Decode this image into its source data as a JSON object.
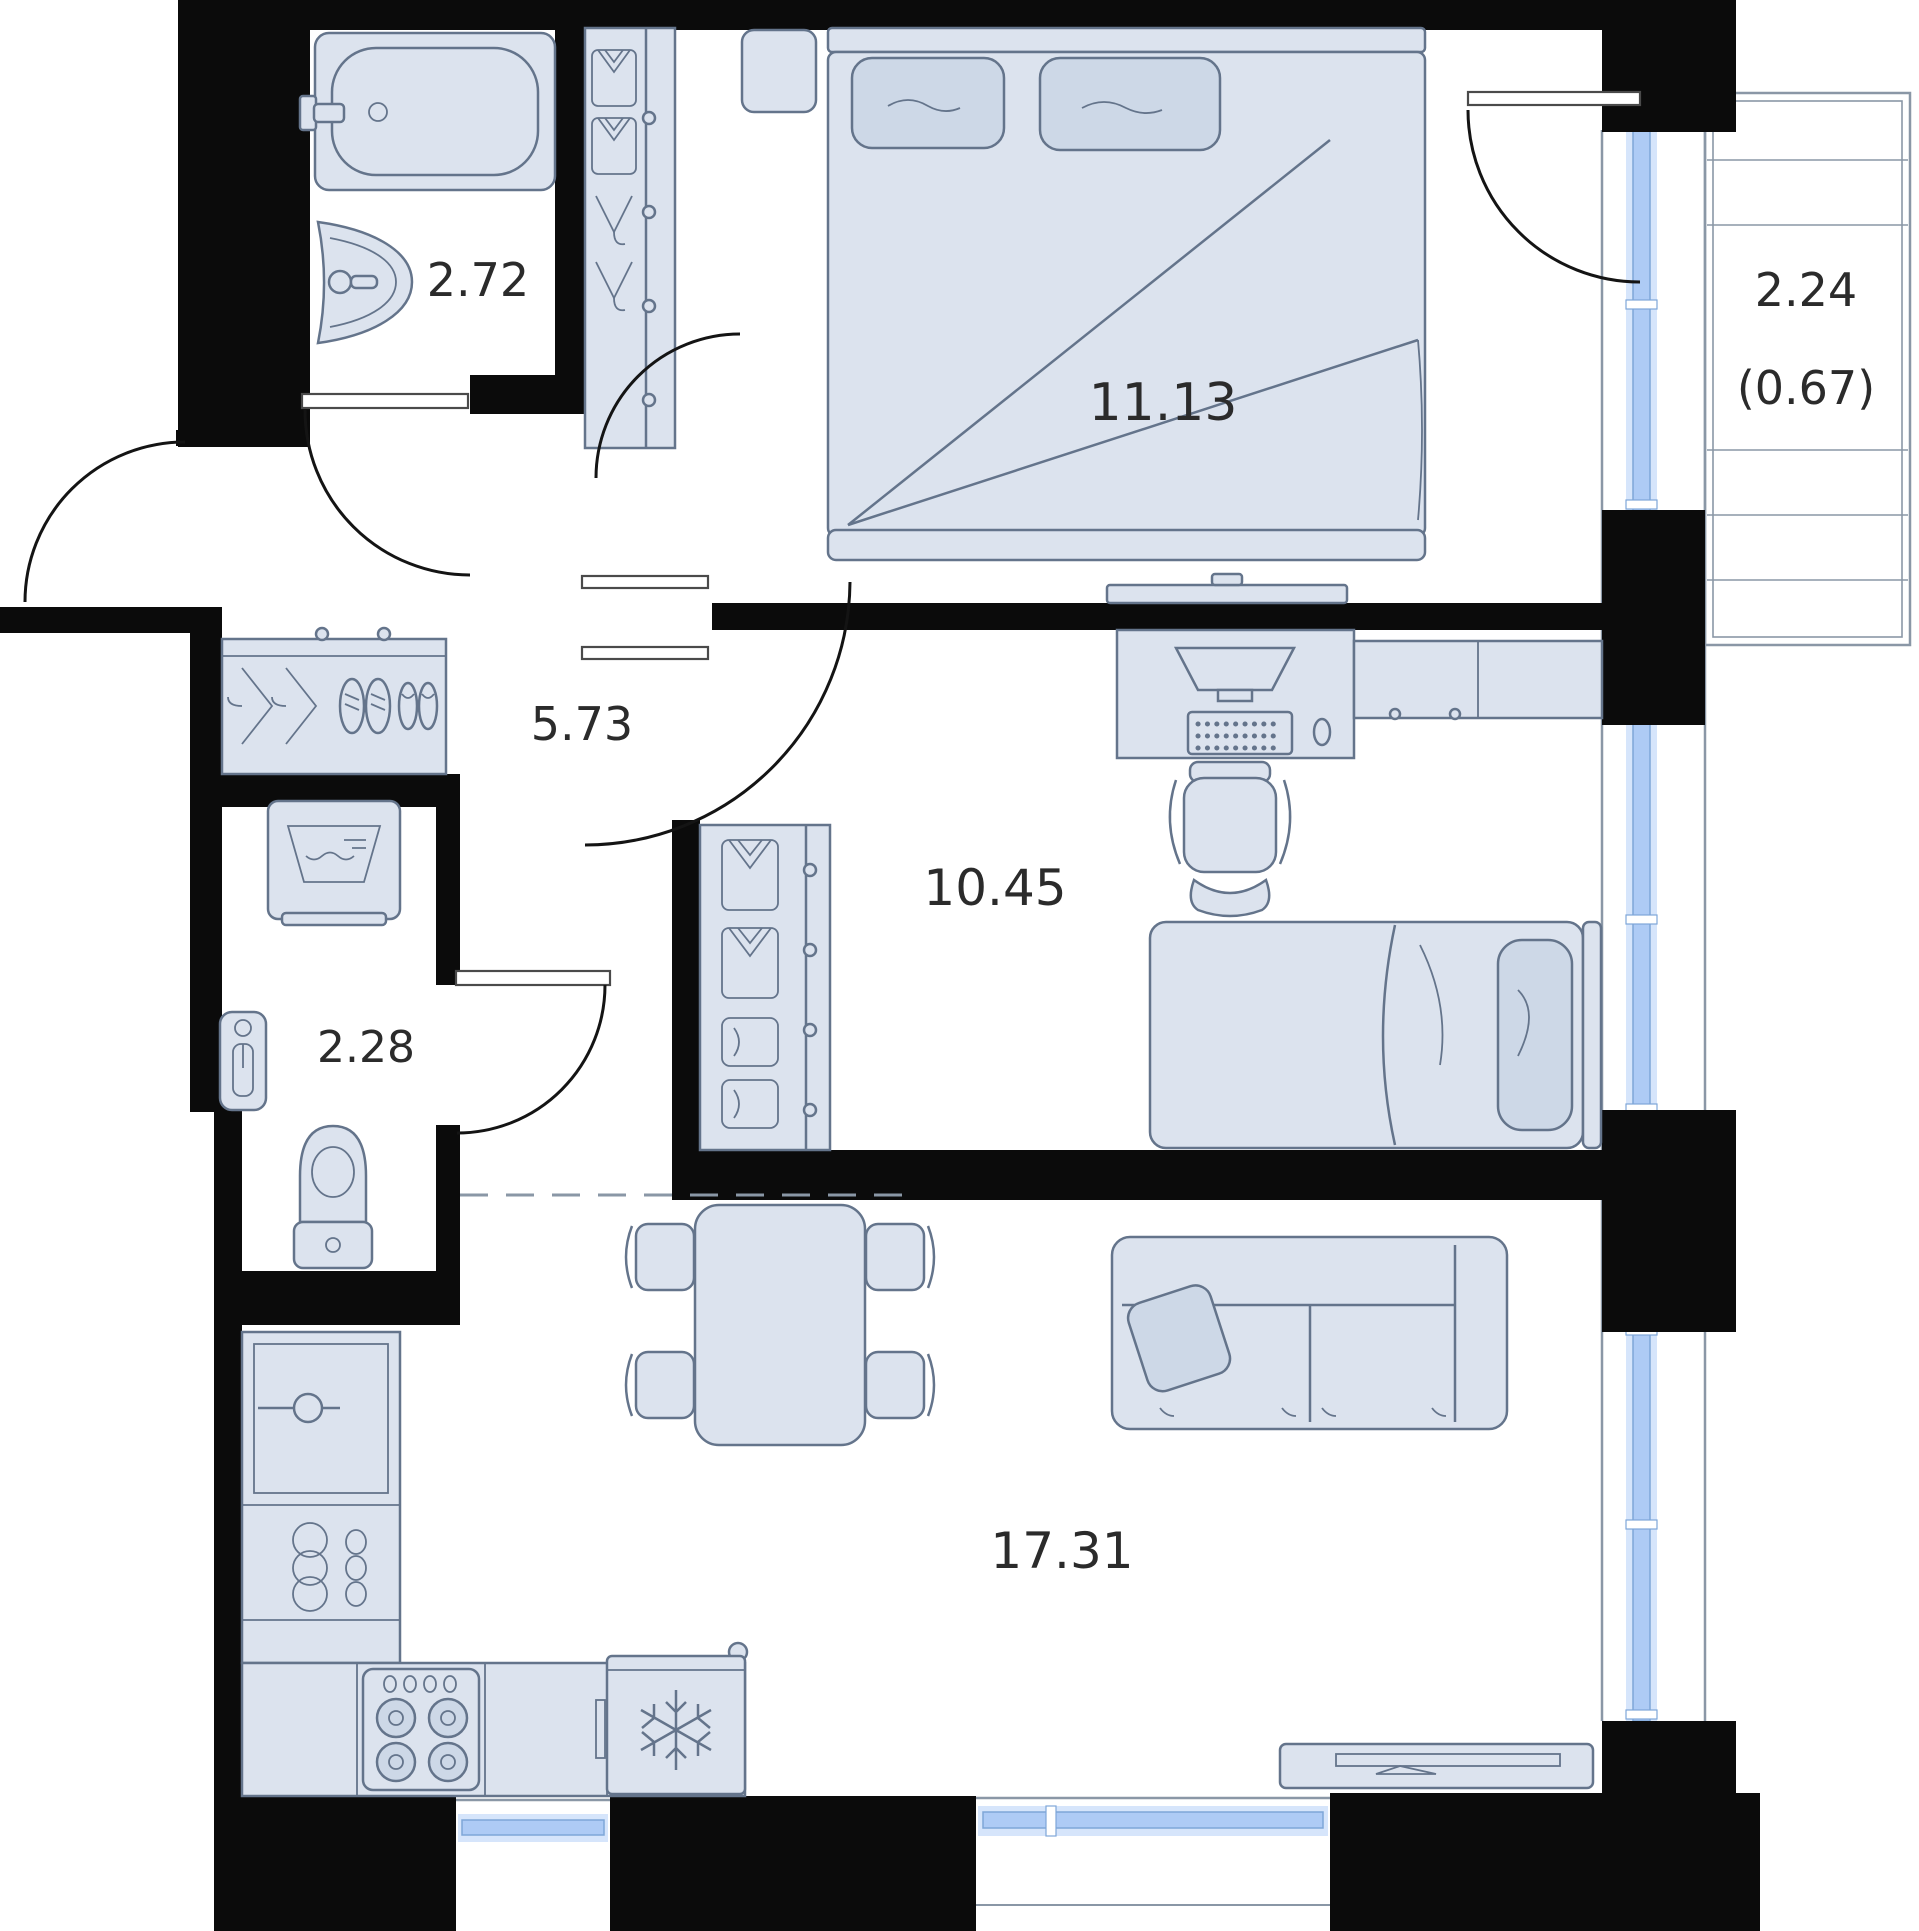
{
  "plan": {
    "title": "apartment-floor-plan",
    "colors": {
      "wall": "#0b0b0b",
      "furniture_fill": "#dce3ee",
      "furniture_stroke": "#64748b",
      "window_glass": "#aecbf5",
      "balcony_frame": "#8a97a6",
      "label_text": "#2b2b2b",
      "background": "#ffffff"
    },
    "rooms": {
      "bathroom": {
        "name": "bathroom",
        "area": "2.72"
      },
      "bedroom": {
        "name": "bedroom",
        "area": "11.13"
      },
      "balcony": {
        "name": "balcony",
        "area": "2.24",
        "area_reduced": "(0.67)"
      },
      "hallway": {
        "name": "hallway",
        "area": "5.73"
      },
      "room": {
        "name": "room",
        "area": "10.45"
      },
      "wc": {
        "name": "wc",
        "area": "2.28"
      },
      "kitchen_living": {
        "name": "kitchen-living",
        "area": "17.31"
      }
    },
    "icons": [
      "bathtub-icon",
      "sink-icon",
      "wardrobe-icon",
      "hanger-icon",
      "shoes-icon",
      "double-bed-icon",
      "pillow-icon",
      "bedside-table-icon",
      "tv-icon",
      "desk-icon",
      "monitor-icon",
      "keyboard-icon",
      "mouse-icon",
      "office-chair-icon",
      "cabinet-icon",
      "single-bed-icon",
      "sofa-icon",
      "dining-table-icon",
      "chair-icon",
      "washing-machine-icon",
      "water-heater-icon",
      "toilet-icon",
      "kitchen-counter-icon",
      "stove-icon",
      "fridge-icon",
      "snowflake-icon",
      "tv-console-icon",
      "window-icon",
      "door-swing-icon",
      "balcony-deck-icon"
    ]
  }
}
